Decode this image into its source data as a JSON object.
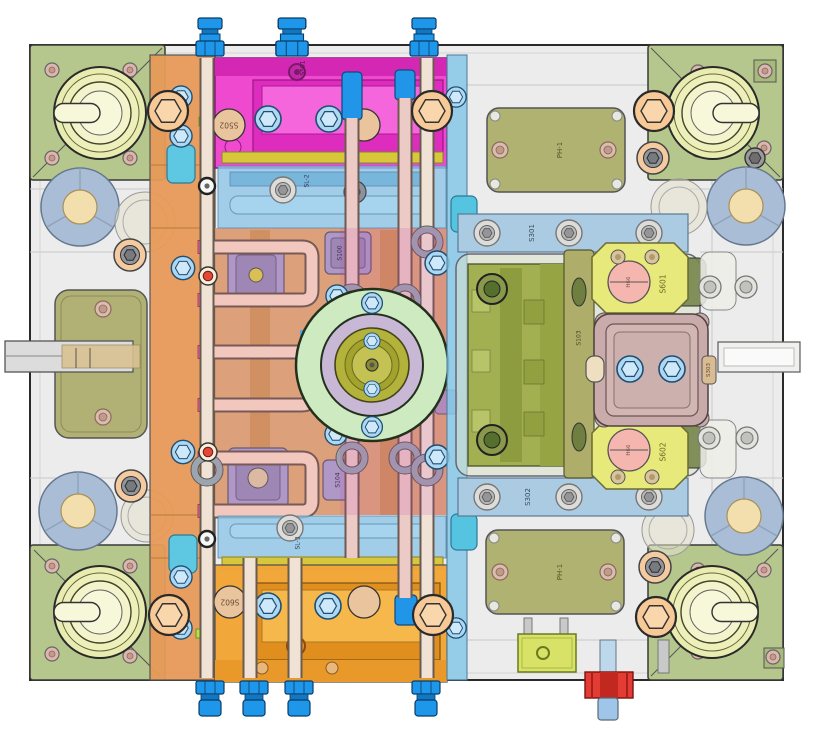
{
  "palette": {
    "base_plate": "#ececec",
    "corner_plate": "#b5c78c",
    "guide_bushing": "#eff0bc",
    "locating_ring": "#cdeac1",
    "sprue_bushing": "#b3b23a",
    "hot_runner_block": "#ee41cd",
    "manifold_strip": "#e79a58",
    "bottom_block": "#f2a435",
    "cooling_pipe": "#f3d0bd",
    "water_fitting_blue": "#1e96ea",
    "red_fitting": "#e23c34",
    "clamp_strip_blue": "#abcbe3",
    "core_block": "#a3b052",
    "bracket_yellow": "#e7e97b",
    "mauve_block": "#c9abac",
    "ph_plate": "#b0b271",
    "support_pillar": "#a9bdd6"
  },
  "labels": {
    "s501": "S501",
    "s502": "S502",
    "s602": "S602",
    "s100": "S100",
    "s103": "S103",
    "s104": "S104",
    "sl2": "SL-2",
    "sl3": "SL-3",
    "s301": "S301",
    "s302": "S302",
    "s303": "S303",
    "s601": "S601",
    "h66": "H66",
    "ph1": "PH-1"
  },
  "legend": {
    "part_labels_visible": [
      "S100",
      "S103",
      "S104",
      "S301",
      "S302",
      "S303",
      "S501",
      "S502",
      "S601",
      "S602",
      "SL-2",
      "SL-3",
      "H66",
      "PH-1"
    ]
  }
}
